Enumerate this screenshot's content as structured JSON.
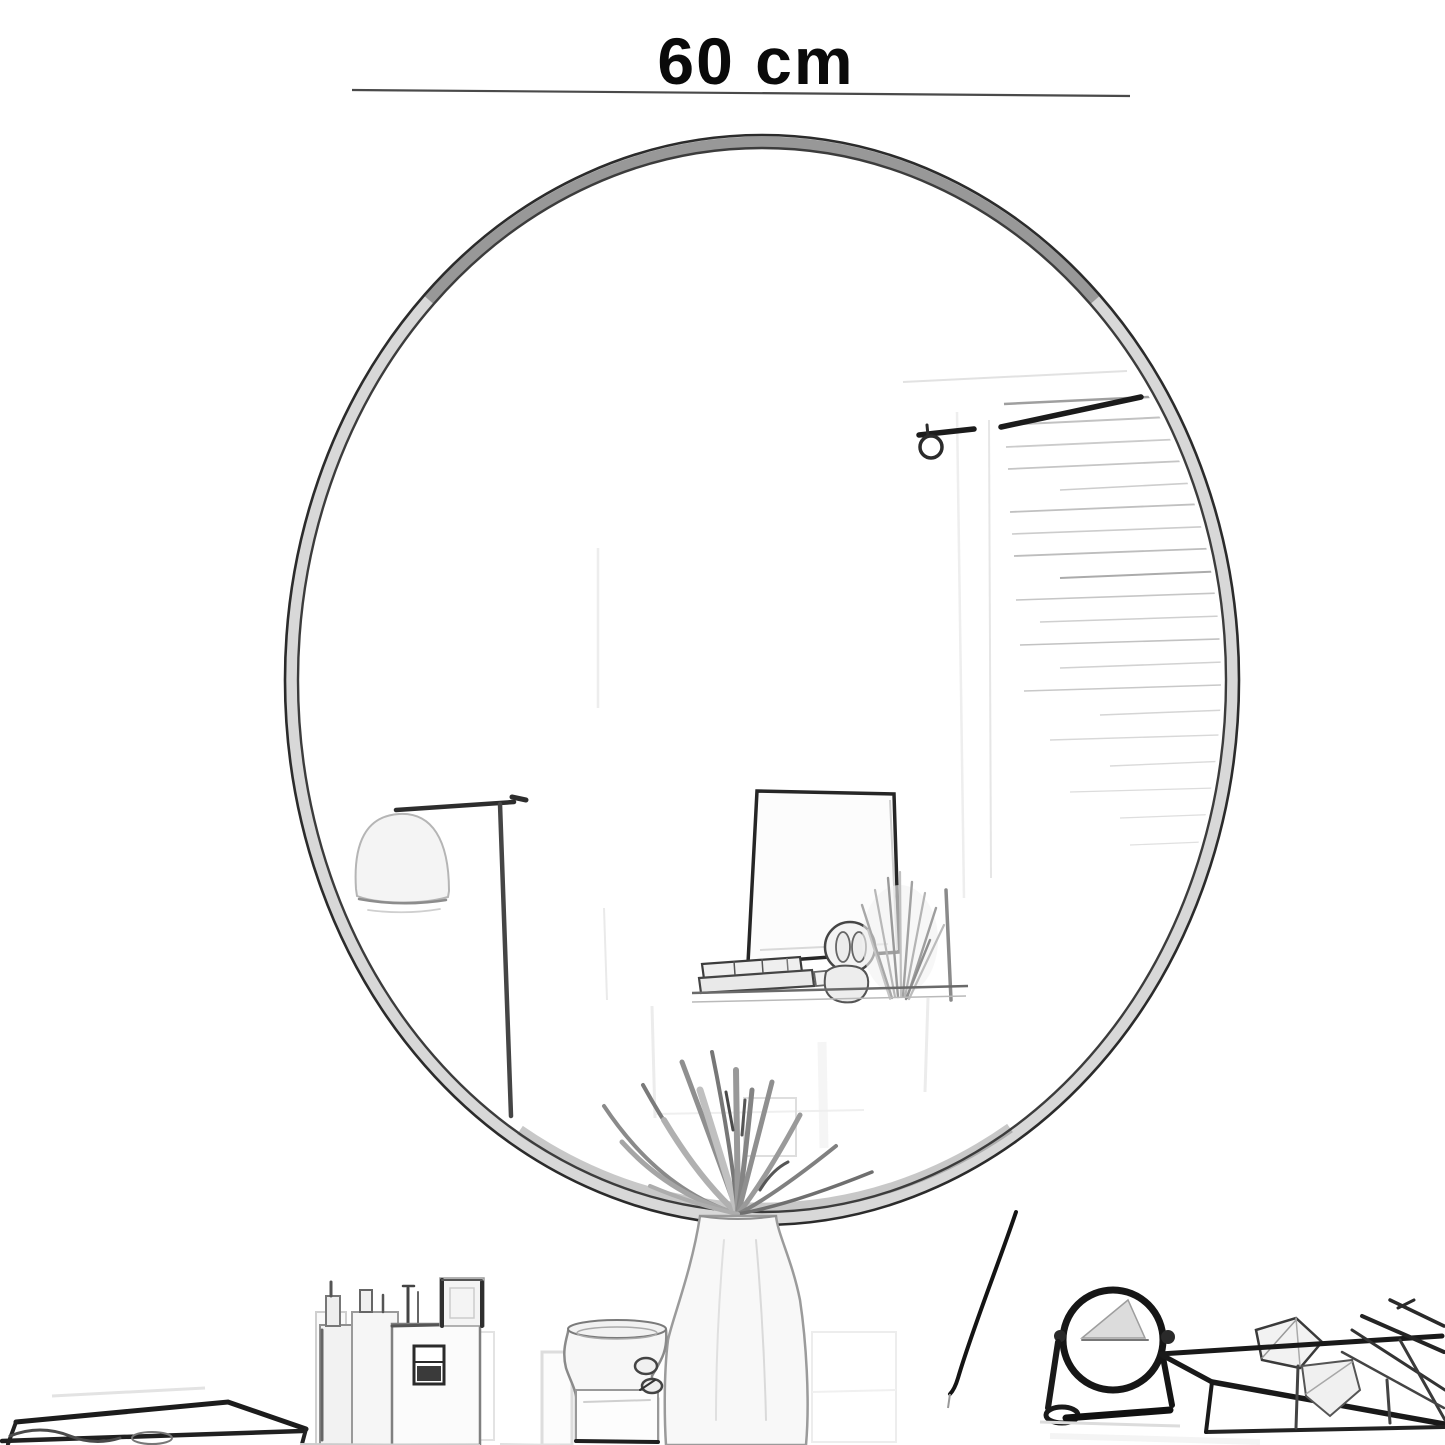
{
  "product_diagram": {
    "dimension_label": "60 cm",
    "text_color": "#0a0a0a",
    "dimension_line_color": "#4a4a4a",
    "background_color": "#ffffff",
    "sketch_palette": {
      "ink_dark": "#1e1e1e",
      "ink_mid": "#707070",
      "ink_light": "#c6c6c6",
      "ink_faint": "#ebebeb"
    }
  }
}
